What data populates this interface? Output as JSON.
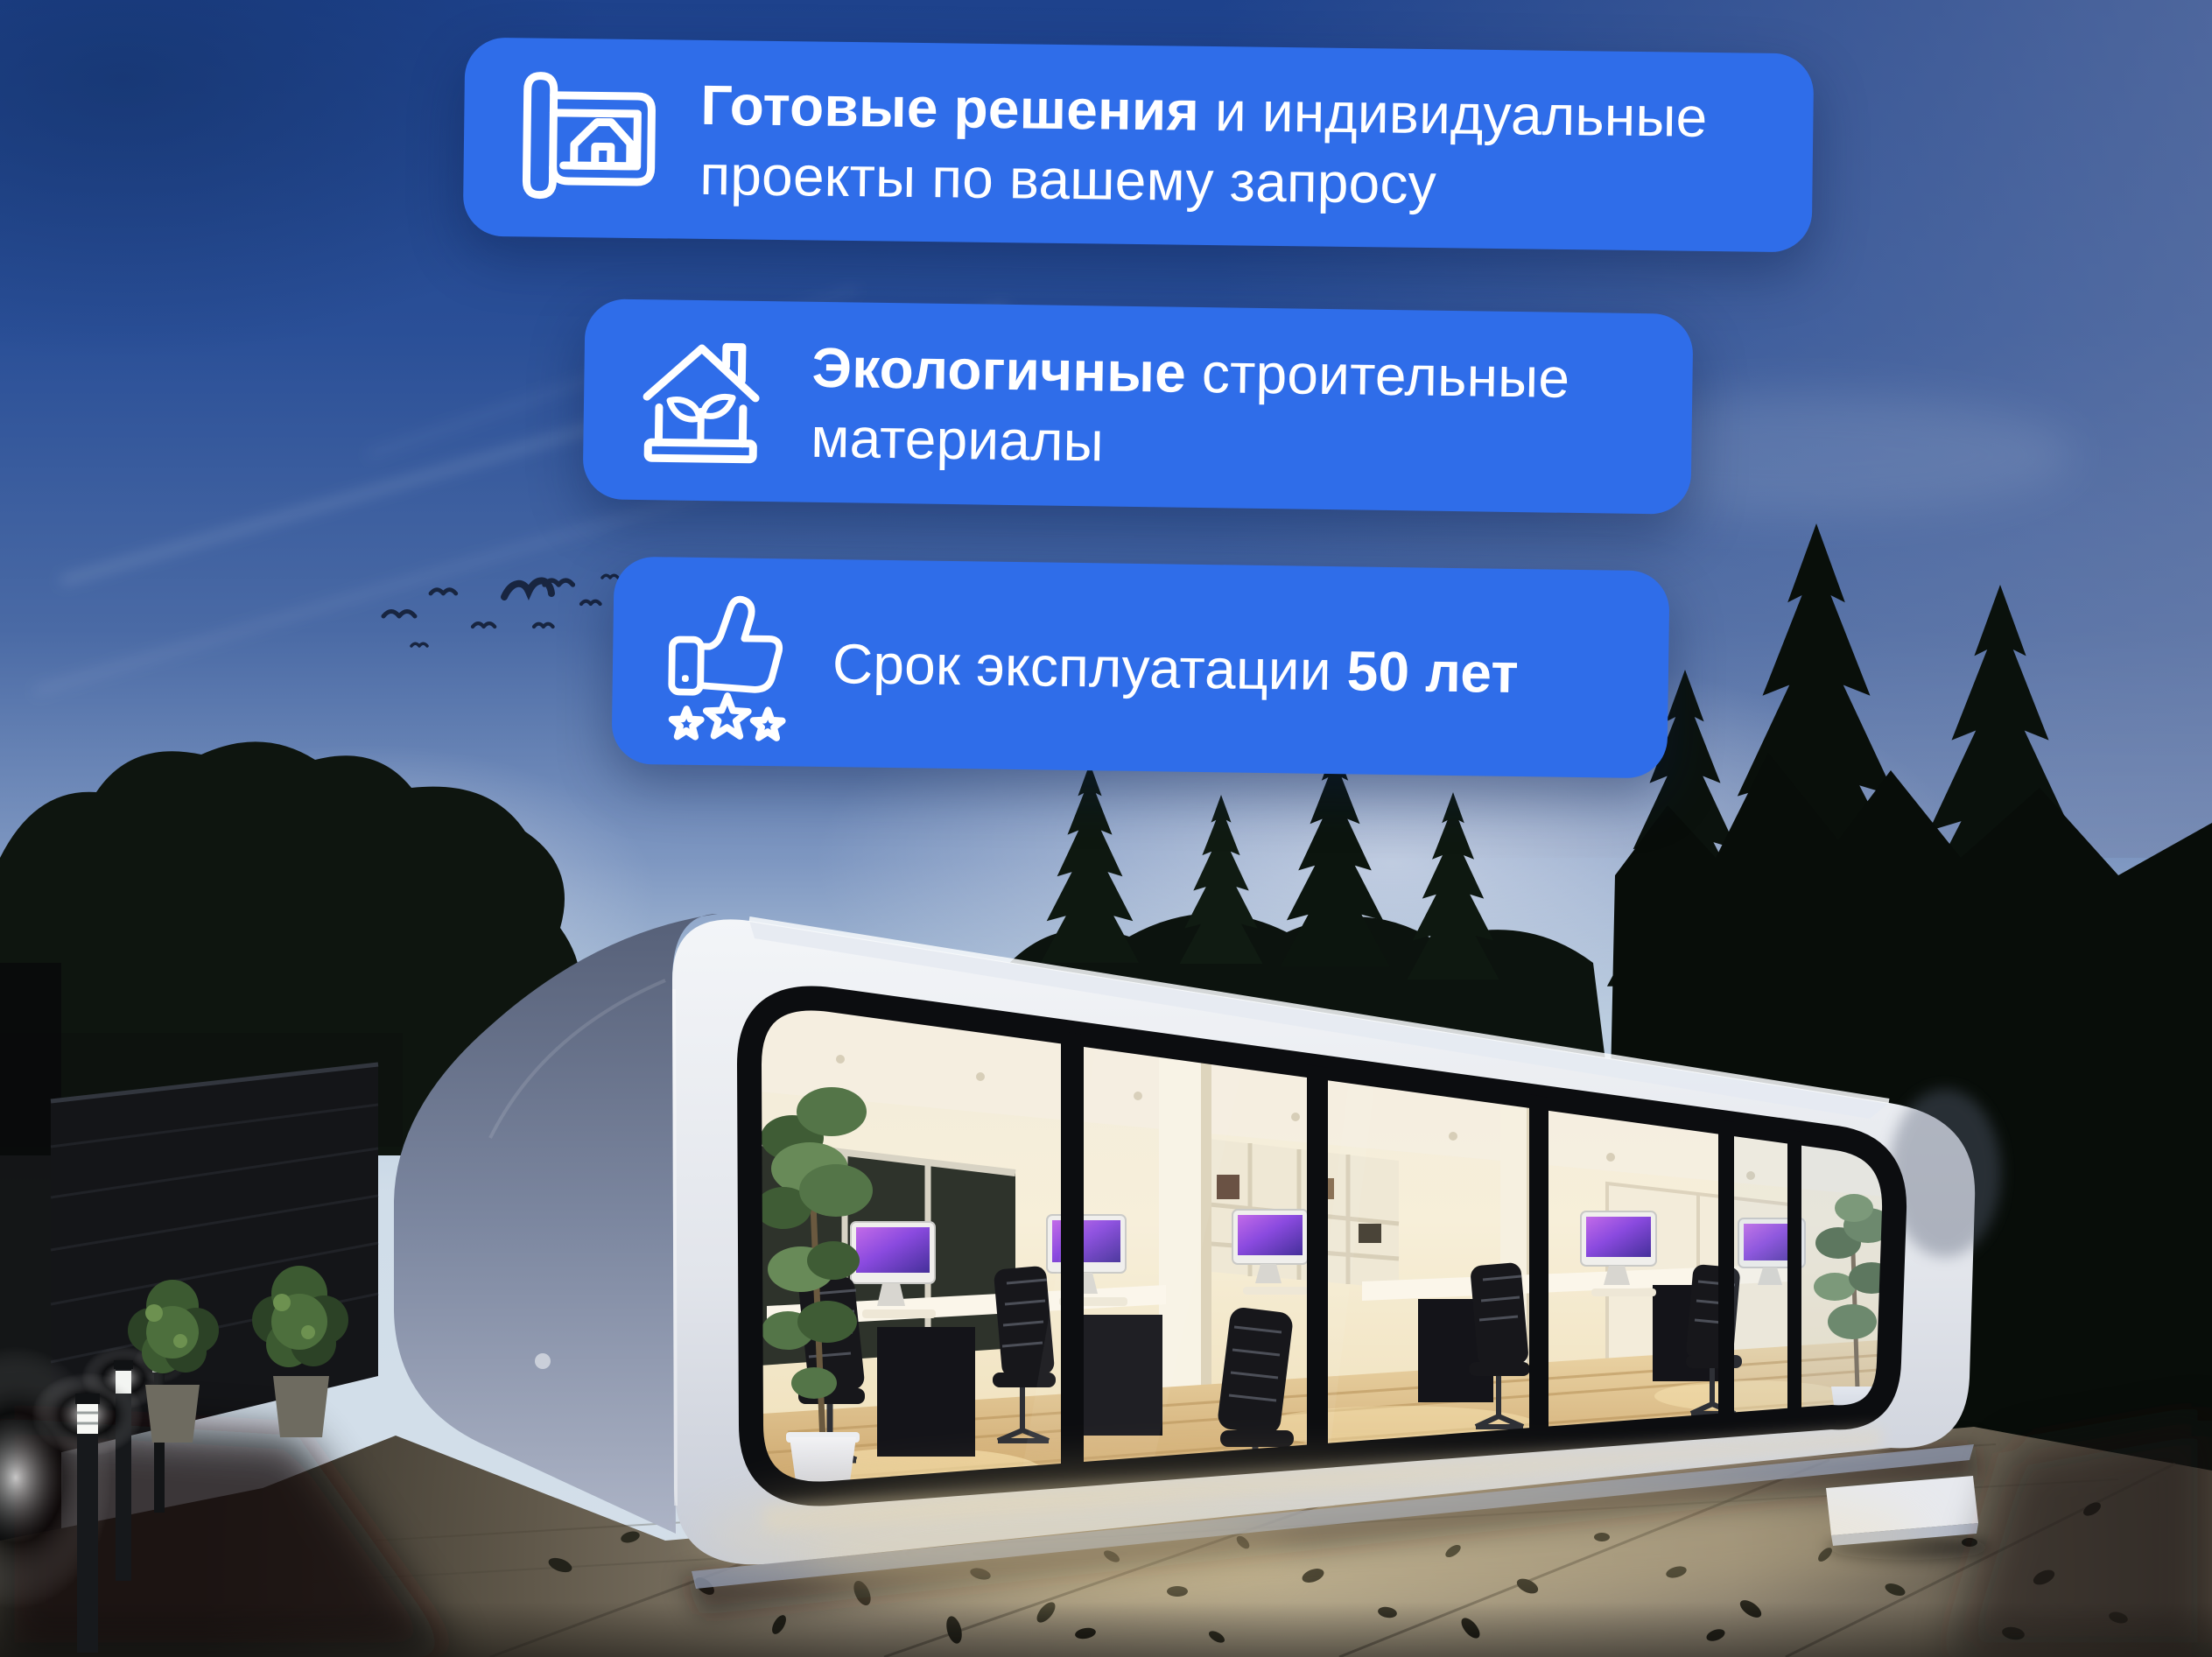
{
  "meta": {
    "type": "advertising-banner",
    "language": "ru"
  },
  "colors": {
    "card_background": "#2F6DE9",
    "card_text": "#FFFFFF",
    "icon_stroke": "#FFFFFF",
    "sky_top": "#1E428C",
    "sky_horizon": "#CFDCE8",
    "trees": "#0C120D",
    "ground_lit": "#A99F87",
    "interior_glow": "#F6EED8"
  },
  "cards": [
    {
      "name": "ready-solutions",
      "icon": "blueprint-house-icon",
      "lines": [
        {
          "segments": [
            {
              "text": "Готовые решения",
              "bold": true
            },
            {
              "text": " и индивидуальные",
              "bold": false
            }
          ]
        },
        {
          "segments": [
            {
              "text": "проекты по вашему запросу",
              "bold": false
            }
          ]
        }
      ]
    },
    {
      "name": "eco-materials",
      "icon": "eco-house-sprout-icon",
      "lines": [
        {
          "segments": [
            {
              "text": "Экологичные",
              "bold": true
            },
            {
              "text": " строительные",
              "bold": false
            }
          ]
        },
        {
          "segments": [
            {
              "text": "материалы",
              "bold": false
            }
          ]
        }
      ]
    },
    {
      "name": "service-life",
      "icon": "thumbs-up-stars-icon",
      "lines": [
        {
          "segments": [
            {
              "text": "Срок эксплуатации ",
              "bold": false
            },
            {
              "text": "50 лет",
              "bold": true
            }
          ]
        }
      ]
    }
  ],
  "scene": {
    "description": "White rounded modular office building with glowing panoramic glass facade at dusk; dark spruce and deciduous tree silhouettes; evening sky with birds and contrails; stone wall, garden bushes and bollard lights at left; paved courtyard with scattered dark leaves"
  }
}
